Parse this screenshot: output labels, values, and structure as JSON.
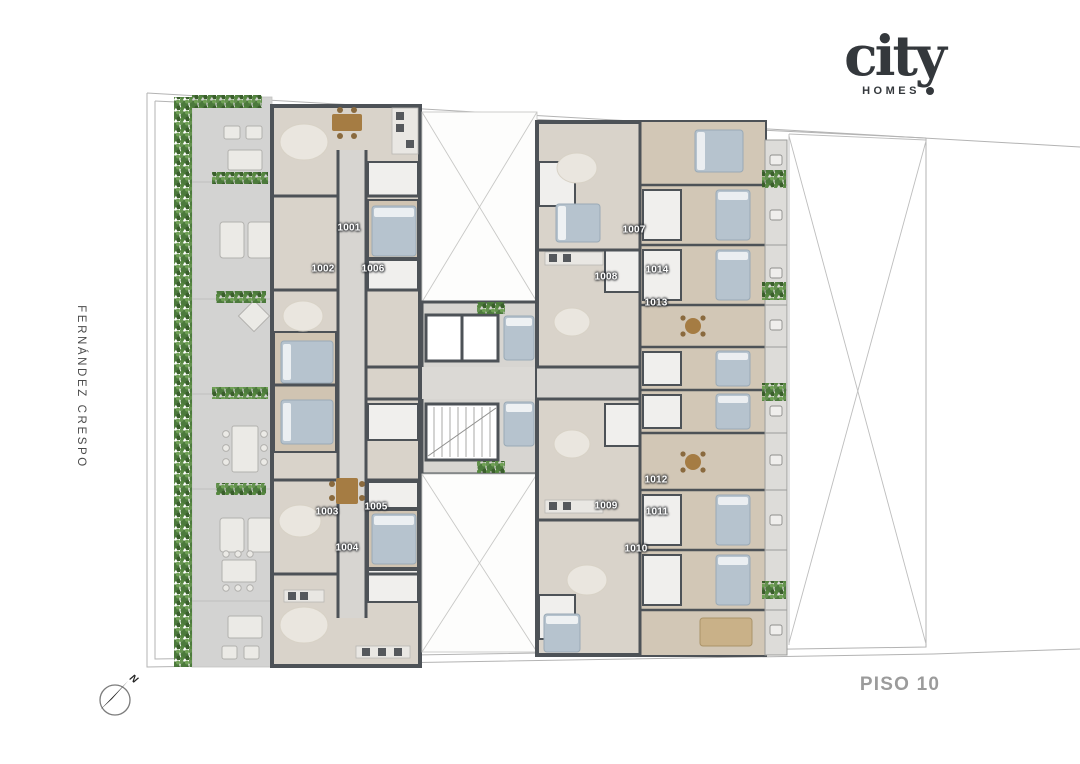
{
  "brand": {
    "name": "city",
    "sub": "HOMES"
  },
  "street": {
    "name": "FERNÁNDEZ CRESPO"
  },
  "floor": {
    "label": "PISO 10"
  },
  "compass": {
    "north_label": "N"
  },
  "units": [
    {
      "label": "1001"
    },
    {
      "label": "1002"
    },
    {
      "label": "1003"
    },
    {
      "label": "1004"
    },
    {
      "label": "1005"
    },
    {
      "label": "1006"
    },
    {
      "label": "1007"
    },
    {
      "label": "1008"
    },
    {
      "label": "1009"
    },
    {
      "label": "1010"
    },
    {
      "label": "1011"
    },
    {
      "label": "1012"
    },
    {
      "label": "1013"
    },
    {
      "label": "1014"
    }
  ],
  "colors": {
    "wall": "#4d5257",
    "floor": "#d9d3ca",
    "floor_wood": "#d0c4b2",
    "corridor": "#d7d5d1",
    "bath": "#f0efed",
    "terrace": "#d3d3d2",
    "hedge_green": "#4c7a3c",
    "bed": "#b6c3ce",
    "wood_furniture": "#a57c43",
    "lot_line": "#b3b3b3",
    "brand_ink": "#34383c",
    "floor_label_ink": "#9b9b9b",
    "unit_label_ink": "#ffffff"
  }
}
